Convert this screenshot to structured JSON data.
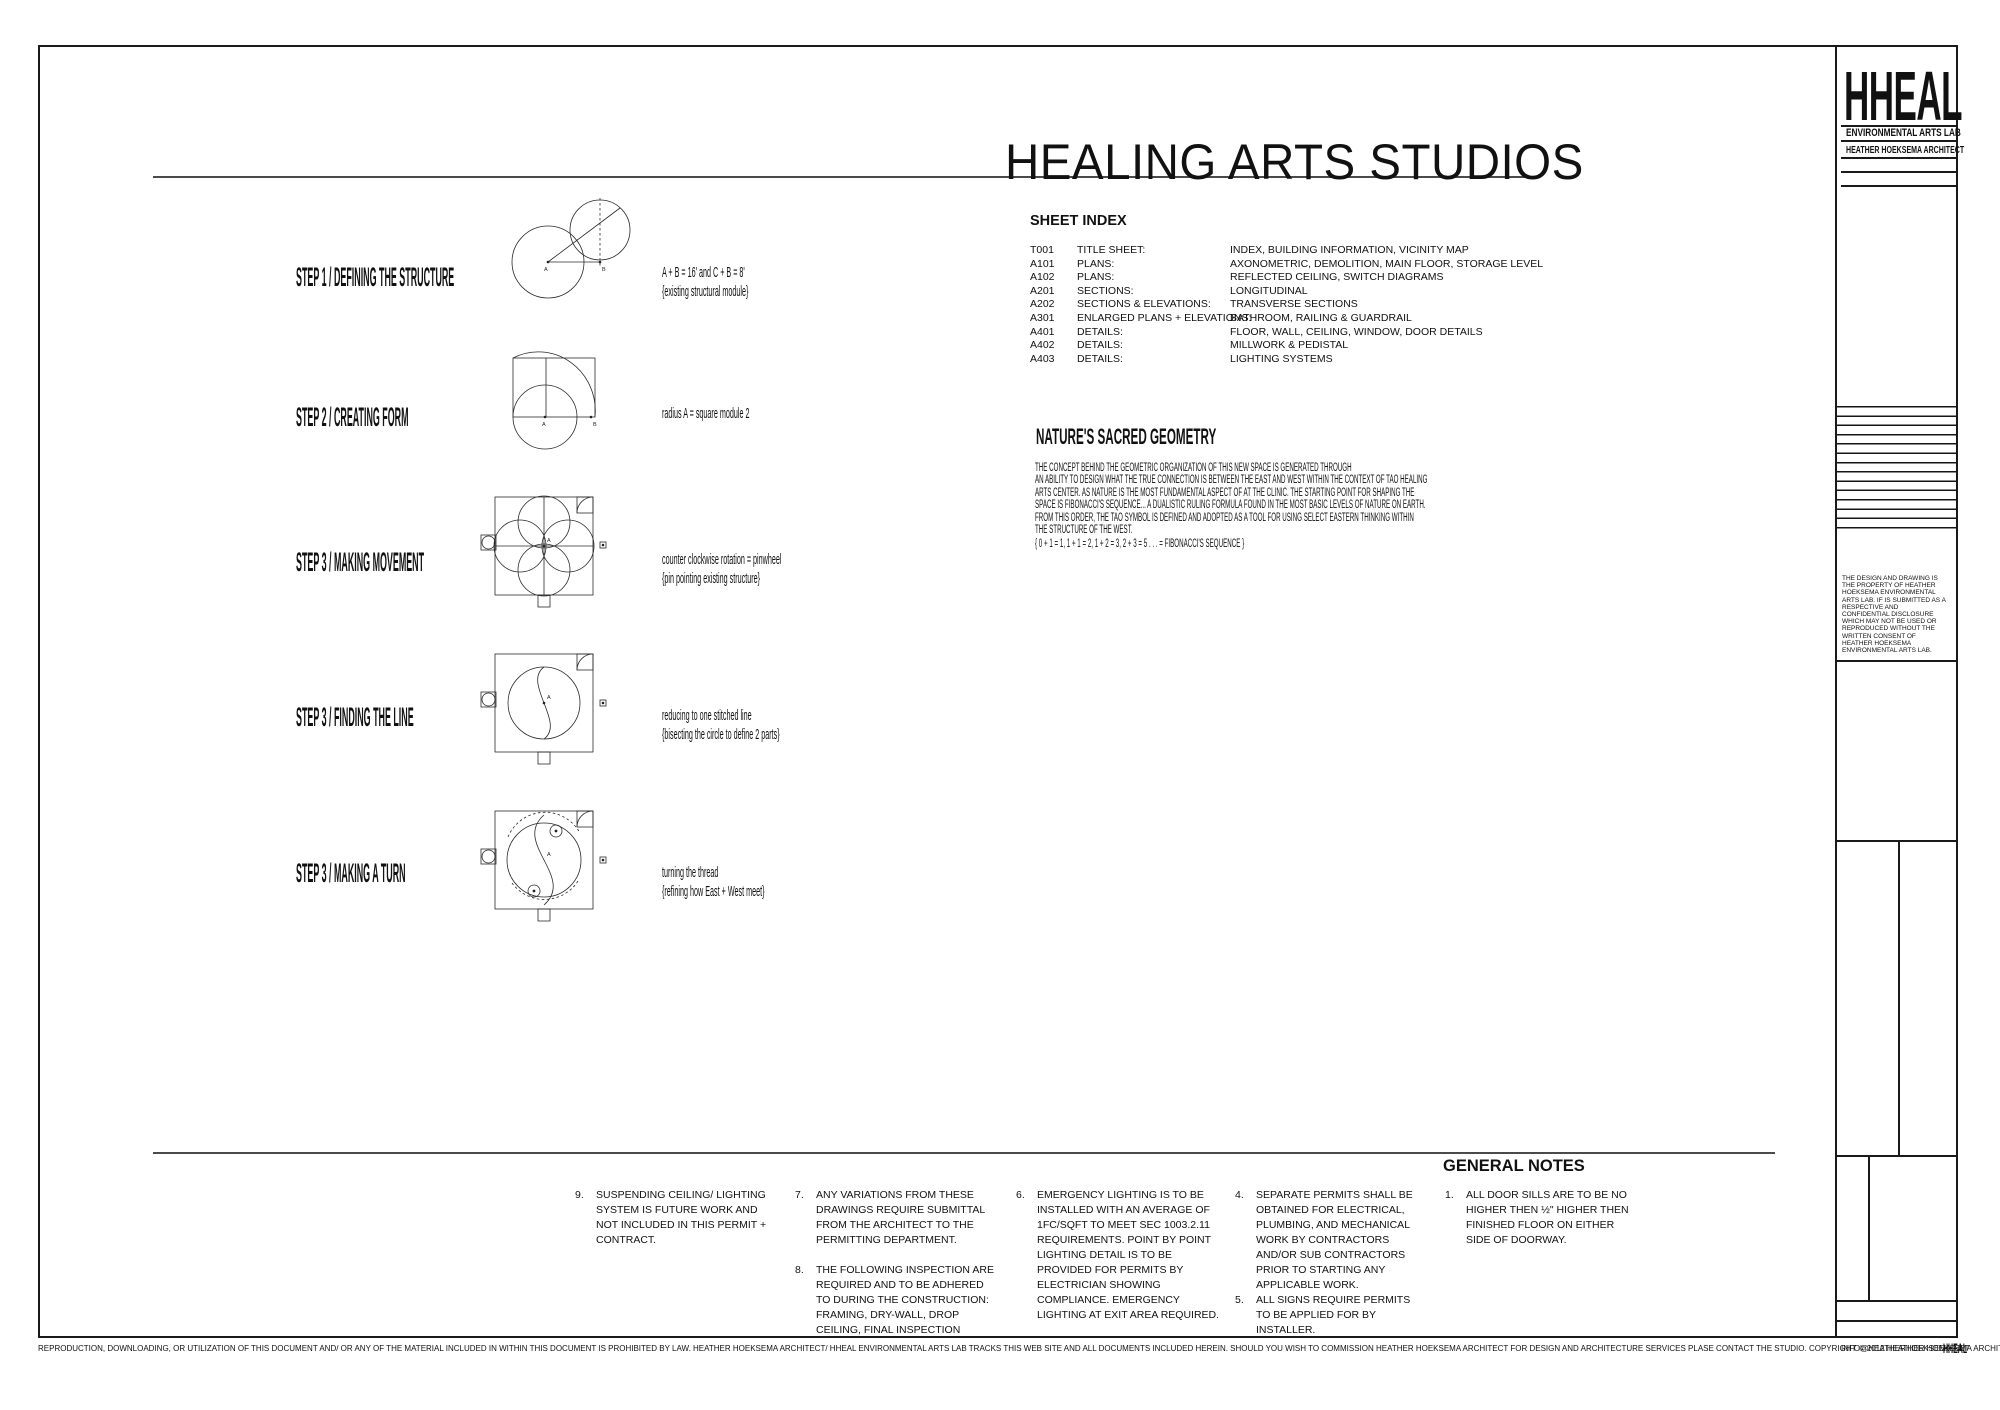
{
  "sheet": {
    "title": "HEALING ARTS STUDIOS"
  },
  "labels": {
    "a": "A",
    "b": "B"
  },
  "steps": [
    {
      "label": "STEP 1 /  DEFINING THE STRUCTURE",
      "note1": "A + B  =  16'  and  C + B = 8'",
      "note2": "{existing structural module}"
    },
    {
      "label": "STEP 2 /  CREATING FORM",
      "note1": "radius A  =  square module 2",
      "note2": ""
    },
    {
      "label": "STEP 3 /  MAKING MOVEMENT",
      "note1": "counter clockwise rotation = pinwheel",
      "note2": "{pin pointing existing structure}"
    },
    {
      "label": "STEP 3 /  FINDING THE LINE",
      "note1": "reducing to one stitched line",
      "note2": "{bisecting the circle to define 2 parts}"
    },
    {
      "label": "STEP 3 / MAKING A TURN",
      "note1": "turning the thread",
      "note2": "{refining how East + West meet}"
    }
  ],
  "sheet_index": {
    "title": "SHEET INDEX",
    "rows": [
      {
        "num": "T001",
        "name": "TITLE SHEET:",
        "desc": "INDEX, BUILDING INFORMATION, VICINITY MAP"
      },
      {
        "num": "A101",
        "name": "PLANS:",
        "desc": "AXONOMETRIC, DEMOLITION, MAIN FLOOR, STORAGE LEVEL"
      },
      {
        "num": "A102",
        "name": "PLANS:",
        "desc": "REFLECTED CEILING, SWITCH DIAGRAMS"
      },
      {
        "num": "A201",
        "name": "SECTIONS:",
        "desc": "LONGITUDINAL"
      },
      {
        "num": "A202",
        "name": "SECTIONS & ELEVATIONS:",
        "desc": "TRANSVERSE SECTIONS"
      },
      {
        "num": "A301",
        "name": "ENLARGED PLANS + ELEVATIONS:",
        "desc": "BATHROOM, RAILING & GUARDRAIL"
      },
      {
        "num": "A401",
        "name": "DETAILS:",
        "desc": "FLOOR, WALL, CEILING, WINDOW, DOOR DETAILS"
      },
      {
        "num": "A402",
        "name": "DETAILS:",
        "desc": "MILLWORK & PEDISTAL"
      },
      {
        "num": "A403",
        "name": "DETAILS:",
        "desc": "LIGHTING SYSTEMS"
      }
    ]
  },
  "sacred": {
    "title": "NATURE'S SACRED GEOMETRY",
    "lines": [
      "THE CONCEPT BEHIND THE GEOMETRIC ORGANIZATION OF THIS NEW SPACE IS GENERATED THROUGH",
      "AN ABILITY TO DESIGN WHAT THE TRUE CONNECTION IS BETWEEN THE EAST AND WEST WITHIN THE CONTEXT OF TAO HEALING",
      "ARTS CENTER.  AS NATURE IS THE MOST FUNDAMENTAL ASPECT OF AT THE CLINIC. THE STARTING POINT FOR SHAPING THE",
      "SPACE IS FIBONACCI'S SEQUENCE... A DUALISTIC RULING FORMULA FOUND IN THE MOST BASIC LEVELS OF NATURE ON EARTH.",
      "FROM THIS ORDER, THE TAO SYMBOL IS DEFINED AND ADOPTED AS A TOOL FOR USING SELECT EASTERN THINKING WITHIN",
      "THE STRUCTURE OF THE WEST."
    ],
    "fibonacci": "{ 0 + 1 = 1,  1 + 1 = 2,  1 + 2 = 3,  2 + 3 = 5 . . .      =   FIBONACCI'S SEQUENCE }"
  },
  "general_notes": {
    "title": "GENERAL NOTES",
    "columns": [
      [
        {
          "num": "9.",
          "text": "SUSPENDING CEILING/ LIGHTING SYSTEM IS FUTURE WORK AND NOT INCLUDED IN THIS PERMIT + CONTRACT."
        }
      ],
      [
        {
          "num": "7.",
          "text": "ANY VARIATIONS FROM THESE DRAWINGS REQUIRE SUBMITTAL FROM THE ARCHITECT TO THE PERMITTING DEPARTMENT."
        },
        {
          "num": "8.",
          "text": "THE FOLLOWING INSPECTION ARE REQUIRED AND TO BE ADHERED TO DURING THE CONSTRUCTION:  FRAMING, DRY-WALL, DROP CEILING, FINAL INSPECTION"
        }
      ],
      [
        {
          "num": "6.",
          "text": "EMERGENCY LIGHTING IS TO BE INSTALLED WITH AN AVERAGE OF 1FC/SQFT TO MEET SEC 1003.2.11 REQUIREMENTS. POINT BY POINT LIGHTING DETAIL IS TO BE PROVIDED FOR PERMITS BY  ELECTRICIAN SHOWING COMPLIANCE.  EMERGENCY LIGHTING AT EXIT AREA REQUIRED."
        }
      ],
      [
        {
          "num": "4.",
          "text": "SEPARATE PERMITS SHALL BE OBTAINED FOR ELECTRICAL, PLUMBING, AND MECHANICAL WORK BY CONTRACTORS AND/OR SUB CONTRACTORS PRIOR TO STARTING ANY APPLICABLE WORK."
        },
        {
          "num": "5.",
          "text": "ALL SIGNS REQUIRE PERMITS TO BE APPLIED FOR BY INSTALLER."
        }
      ],
      [
        {
          "num": "1.",
          "text": "ALL DOOR SILLS ARE TO BE NO HIGHER THEN ½\" HIGHER THEN FINISHED FLOOR ON EITHER SIDE OF DOORWAY."
        }
      ]
    ]
  },
  "title_block": {
    "logo": "HHEAL",
    "org": "ENVIRONMENTAL ARTS LAB",
    "architect": "HEATHER HOEKSEMA ARCHITECT",
    "disclaimer": "THE DESIGN AND DRAWING IS THE PROPERTY OF HEATHER HOEKSEMA ENVIRONMENTAL ARTS LAB. IF IS SUBMITTED AS A RESPECTIVE AND CONFIDENTIAL DISCLOSURE WHICH MAY NOT BE USED OR REPRODUCED WITHOUT THE WRITTEN CONSENT OF HEATHER HOEKSEMA ENVIRONMENTAL ARTS LAB."
  },
  "footer": {
    "legal": "REPRODUCTION, DOWNLOADING, OR UTILIZATION OF THIS DOCUMENT AND/ OR ANY OF THE MATERIAL INCLUDED IN WITHIN THIS DOCUMENT IS PROHIBITED BY LAW.  HEATHER HOEKSEMA ARCHITECT/ HHEAL ENVIRONMENTAL ARTS LAB TRACKS THIS WEB SITE AND ALL DOCUMENTS INCLUDED HEREIN.  SHOULD YOU WISH TO COMMISSION HEATHER HOEKSEMA ARCHITECT FOR DESIGN AND ARCHITECTURE SERVICES PLASE CONTACT THE STUDIO.   COPYRIGHT © 2012 HEATHER HOEKSEMA ARCHITECT/ HHEAL ENVIRONMENTAL ARTS LAB",
    "email": "INFO@HEATHERHOEKSEMA.NET",
    "brand": "HHEAL"
  }
}
